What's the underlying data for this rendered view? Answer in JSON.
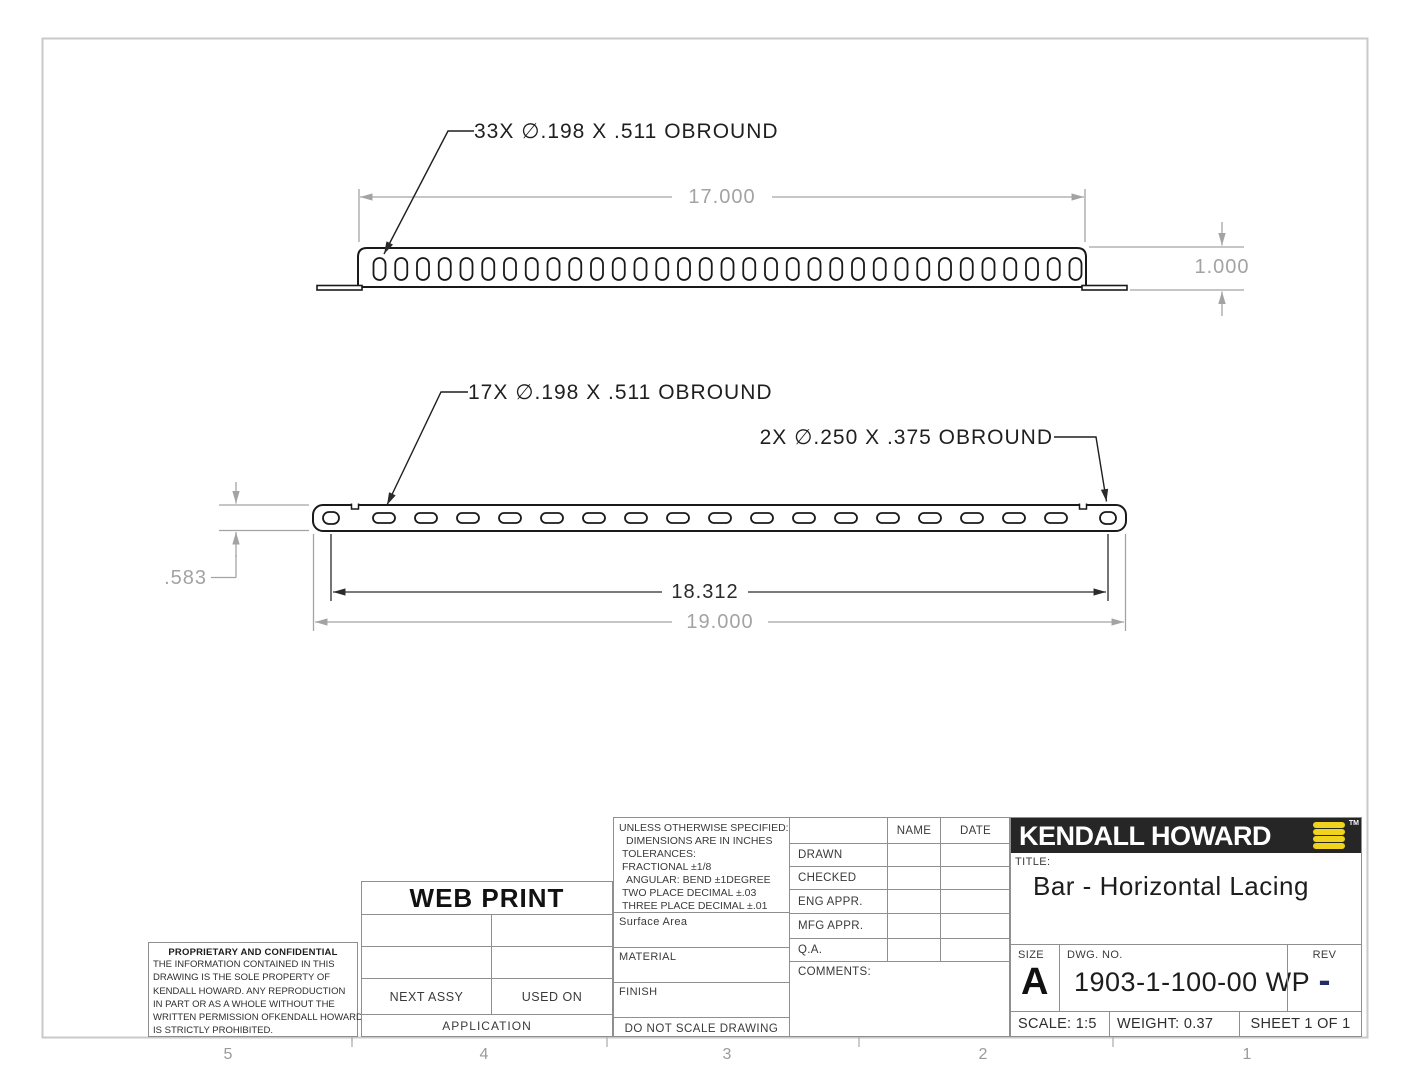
{
  "sheet": {
    "zone_labels": [
      "5",
      "4",
      "3",
      "2",
      "1"
    ]
  },
  "views": {
    "top": {
      "callout": "33X  ∅.198 X .511 OBROUND",
      "dim_width": "17.000",
      "dim_height": "1.000",
      "slot_count": 33
    },
    "front": {
      "callout_slots": "17X  ∅.198 X .511 OBROUND",
      "callout_ends": "2X  ∅.250 X .375 OBROUND",
      "dim_hole_span": "18.312",
      "dim_length": "19.000",
      "dim_height": ".583",
      "slot_count": 17,
      "end_hole_count": 2
    }
  },
  "tolerance_block": {
    "lines": [
      "UNLESS OTHERWISE SPECIFIED:",
      "DIMENSIONS ARE IN INCHES",
      "TOLERANCES:",
      "FRACTIONAL ±1/8",
      "ANGULAR: BEND ±1DEGREE",
      "TWO PLACE DECIMAL  ±.03",
      "THREE PLACE DECIMAL ±.01"
    ],
    "surface_area": "Surface Area",
    "material": "MATERIAL",
    "finish": "FINISH",
    "do_not_scale": "DO NOT SCALE DRAWING"
  },
  "approvals": {
    "name_header": "NAME",
    "date_header": "DATE",
    "rows": [
      "DRAWN",
      "CHECKED",
      "ENG APPR.",
      "MFG APPR.",
      "Q.A."
    ],
    "comments_label": "COMMENTS:"
  },
  "application_block": {
    "watermark": "WEB PRINT",
    "next_assy": "NEXT ASSY",
    "used_on": "USED ON",
    "application": "APPLICATION"
  },
  "proprietary": {
    "heading": "PROPRIETARY AND CONFIDENTIAL",
    "body_lines": [
      "THE INFORMATION CONTAINED IN THIS",
      "DRAWING IS THE SOLE PROPERTY OF",
      "KENDALL HOWARD.  ANY REPRODUCTION",
      "IN PART OR AS A WHOLE WITHOUT THE",
      "WRITTEN PERMISSION OFKENDALL HOWARD",
      "IS STRICTLY PROHIBITED."
    ]
  },
  "title_block": {
    "company": "KENDALL HOWARD",
    "trademark": "TM",
    "title_label": "TITLE:",
    "title": "Bar - Horizontal Lacing",
    "size_label": "SIZE",
    "size": "A",
    "dwg_label": "DWG.  NO.",
    "dwg_no": "1903-1-100-00 WP",
    "rev_label": "REV",
    "rev": "-",
    "scale": "SCALE: 1:5",
    "weight": "WEIGHT: 0.37",
    "sheet": "SHEET 1 OF 1",
    "colors": {
      "logo_yellow": "#efd31c",
      "logo_background": "#262626",
      "rev_navy": "#232d63"
    }
  }
}
